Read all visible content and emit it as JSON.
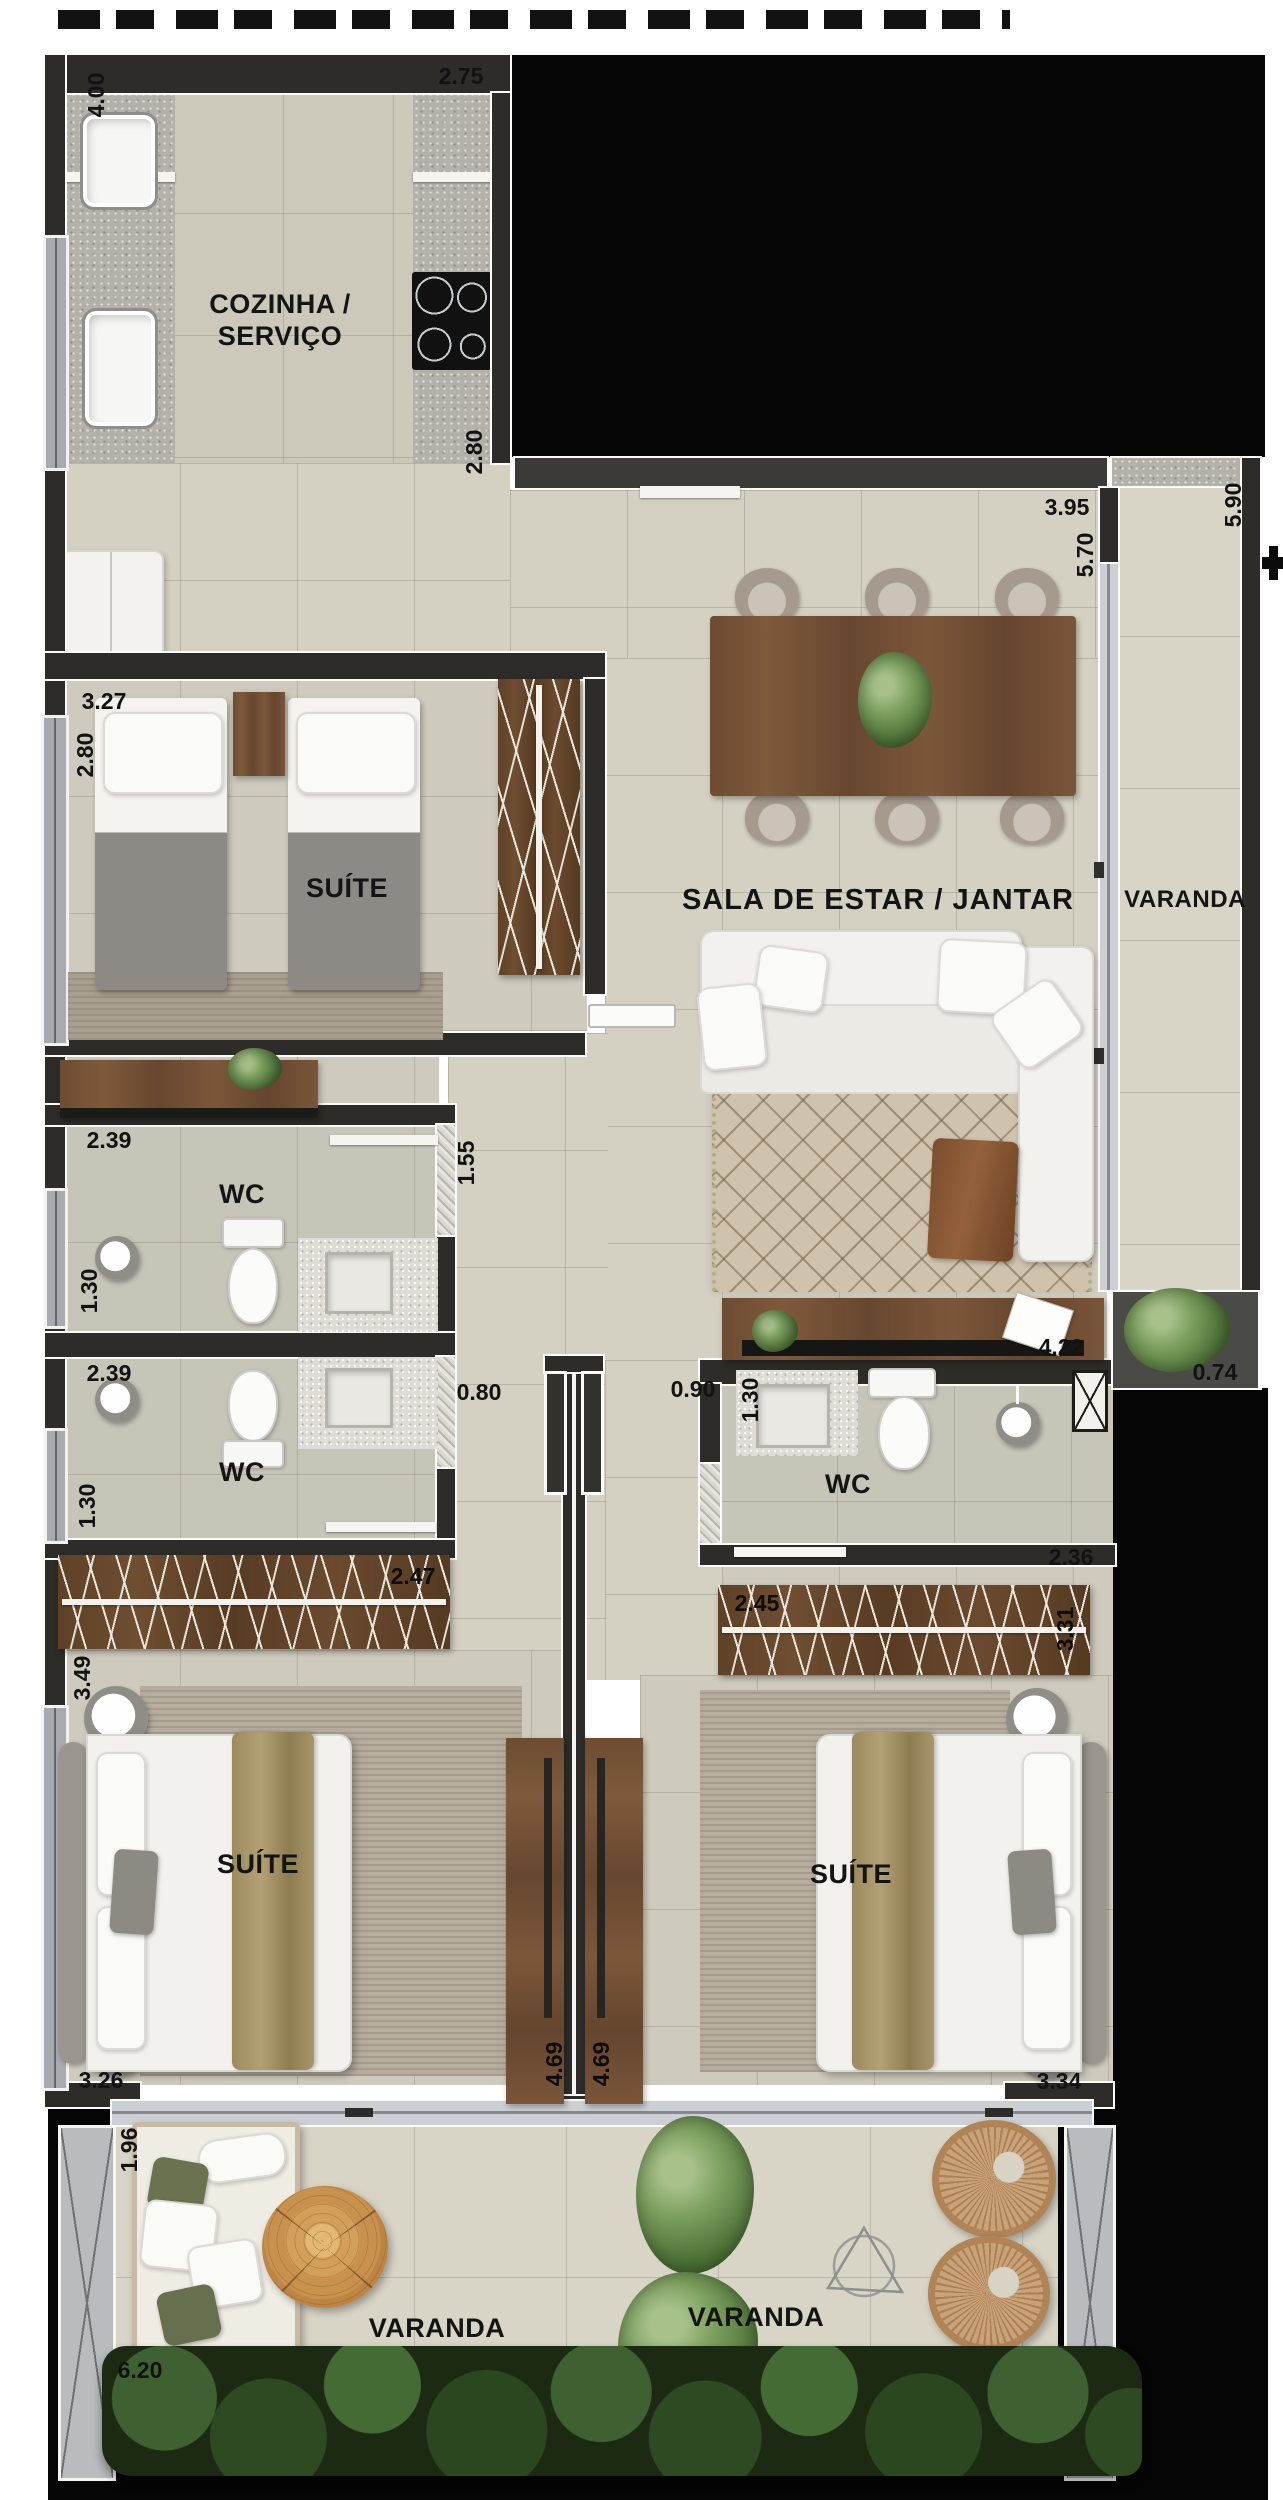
{
  "plan": {
    "rooms": {
      "kitchen": "COZINHA / SERVIÇO",
      "suite_top": "SUÍTE",
      "living": "SALA DE ESTAR / JANTAR",
      "varanda_side": "VARANDA",
      "wc_top": "WC",
      "wc_mid": "WC",
      "wc_right": "WC",
      "suite_left": "SUÍTE",
      "suite_right": "SUÍTE",
      "varanda_bottom_left": "VARANDA",
      "varanda_bottom_right": "VARANDA"
    },
    "dims": {
      "kitchen_height_v": "4.00",
      "kitchen_top": "2.75",
      "kitchen_depth_v": "2.80",
      "living_top": "3.95",
      "varanda_height_v": "5.90",
      "living_height_v": "5.70",
      "suite_top_width": "3.27",
      "suite_top_depth_v": "2.80",
      "wc1_width": "2.39",
      "wc1_depth_v": "1.30",
      "hall_v": "1.55",
      "wc2_width": "2.39",
      "wc2_depth_v": "1.30",
      "wc2_door": "0.80",
      "closet_left": "2.47",
      "suite_left_depth_v": "3.49",
      "suite_left_width": "3.26",
      "divider_left_v": "4.69",
      "divider_right_v": "4.69",
      "wc3_door": "0.90",
      "wc3_depth_v": "1.30",
      "desk_width": "4.22",
      "varanda_planter": "0.74",
      "wc3_width": "2.36",
      "closet_right": "2.45",
      "closet_right_v": "3.31",
      "suite_right_width": "3.34",
      "varanda_sofa_v": "1.96",
      "varanda_bottom_width": "6.20"
    }
  }
}
